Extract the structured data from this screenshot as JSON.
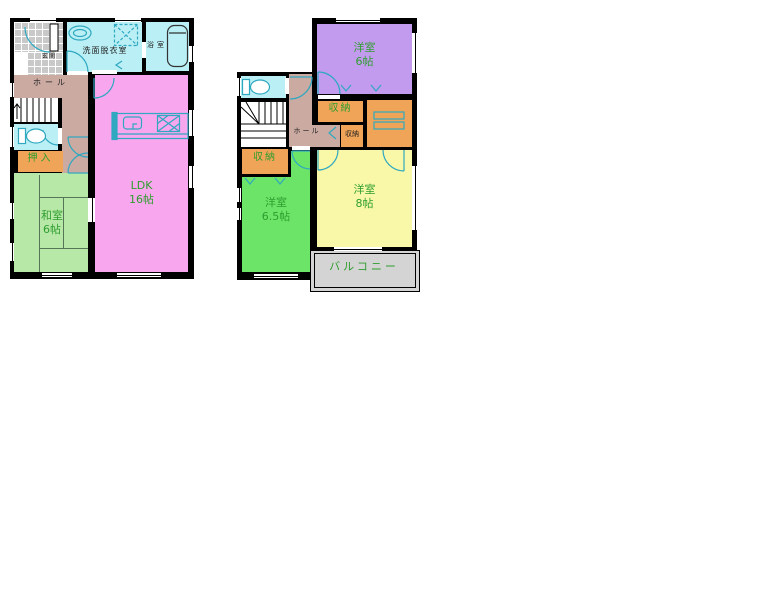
{
  "plan": {
    "floor1": {
      "genkan_label": "玄関",
      "washroom_label": "洗面脱衣室",
      "bath_label": "浴室",
      "hall_label": "ホール",
      "oshiire_label": "押入",
      "washitsu_name": "和室",
      "washitsu_size": "6帖",
      "ldk_name": "LDK",
      "ldk_size": "16帖"
    },
    "floor2": {
      "hall_label": "ホール",
      "closet_top_label": "収納",
      "closet_small_label": "収納",
      "closet_left_label": "収納",
      "bedroom6_name": "洋室",
      "bedroom6_size": "6帖",
      "bedroom65_name": "洋室",
      "bedroom65_size": "6.5帖",
      "bedroom8_name": "洋室",
      "bedroom8_size": "8帖",
      "balcony_label": "バルコニー"
    },
    "colors": {
      "wall": "#000000",
      "ldk_pink": "#f8a6ee",
      "tatami_green": "#b8e8a8",
      "bedroom_green": "#6ce468",
      "bedroom_purple": "#c29bee",
      "bedroom_yellow": "#f8f8a8",
      "closet_orange": "#f0a458",
      "water_cyan": "#b9eff5",
      "hall_brown": "#cbaaa2",
      "balcony_gray": "#d4d4d4",
      "fixture_teal": "#2fa8c0",
      "label_green": "#2e9e2e"
    }
  }
}
